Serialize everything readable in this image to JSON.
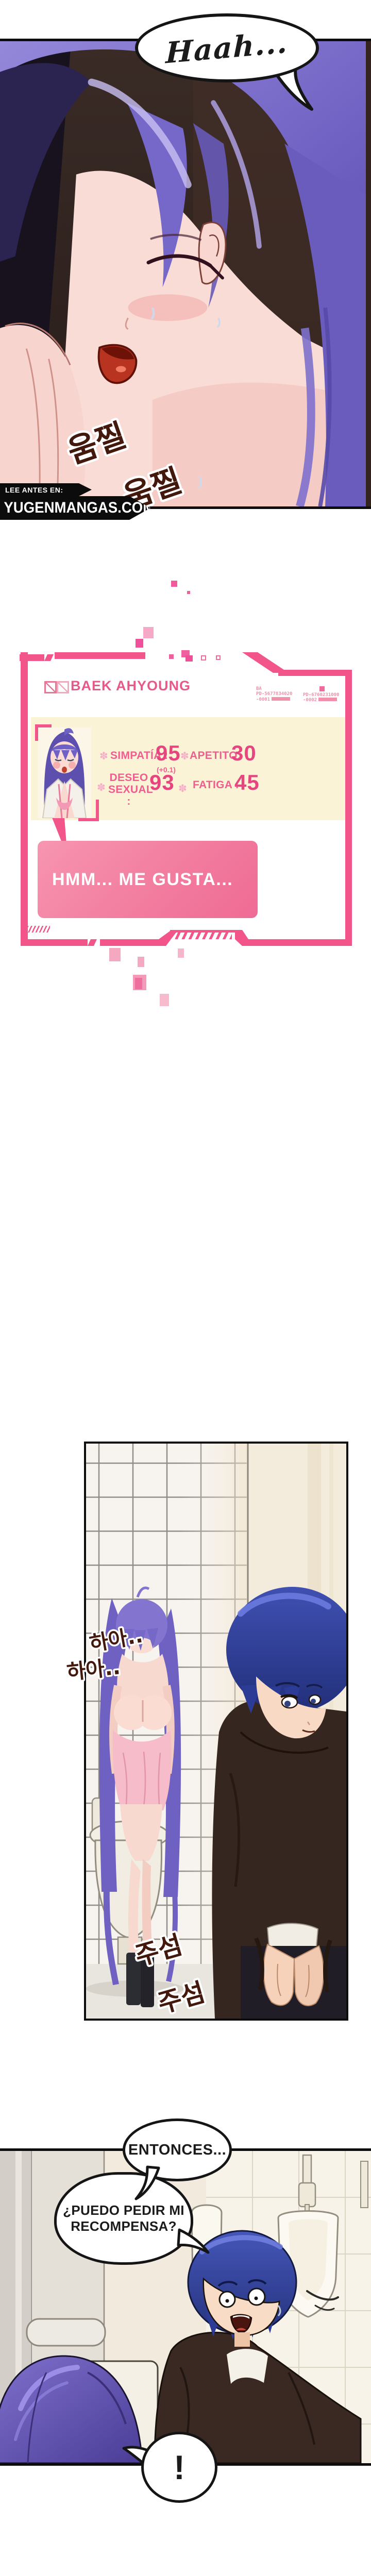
{
  "panel1": {
    "bubble": "Haah...",
    "sfx1": "움찔",
    "sfx2": "움찔",
    "watermark": {
      "lead": "LEE ANTES EN:",
      "site": "YUGENMANGAS.COM"
    }
  },
  "status_panel": {
    "name": "BAEK AHYOUNG",
    "bullet": "✽",
    "codes": {
      "owner": "BA",
      "c1": "PD-5677834020",
      "c1b": "-0001",
      "c2": "PD-6760231000",
      "c2b": "-0002"
    },
    "stats": [
      {
        "label": "SIMPATÍA :",
        "value": "95",
        "note": "(+0.1)"
      },
      {
        "label": "APETITO:",
        "value": "30",
        "note": ""
      },
      {
        "label": "DESEO SEXUAL :",
        "value": "93",
        "note": ""
      },
      {
        "label": "FATIGA :",
        "value": "45",
        "note": ""
      }
    ],
    "speech": "HMM... ME GUSTA...",
    "colors": {
      "accent": "#f2558a",
      "cream": "#faf3d6",
      "speech_pink": "#f27d9f",
      "text_pink": "#ee5f90"
    }
  },
  "panel2": {
    "sfx1": "하아..",
    "sfx2": "하아..",
    "sfx3": "주섬",
    "sfx4": "주섬"
  },
  "panel3": {
    "bubble1": "ENTONCES...",
    "bubble2": "¿PUEDO PEDIR MI RECOMPENSA?",
    "bubble3": "!"
  }
}
